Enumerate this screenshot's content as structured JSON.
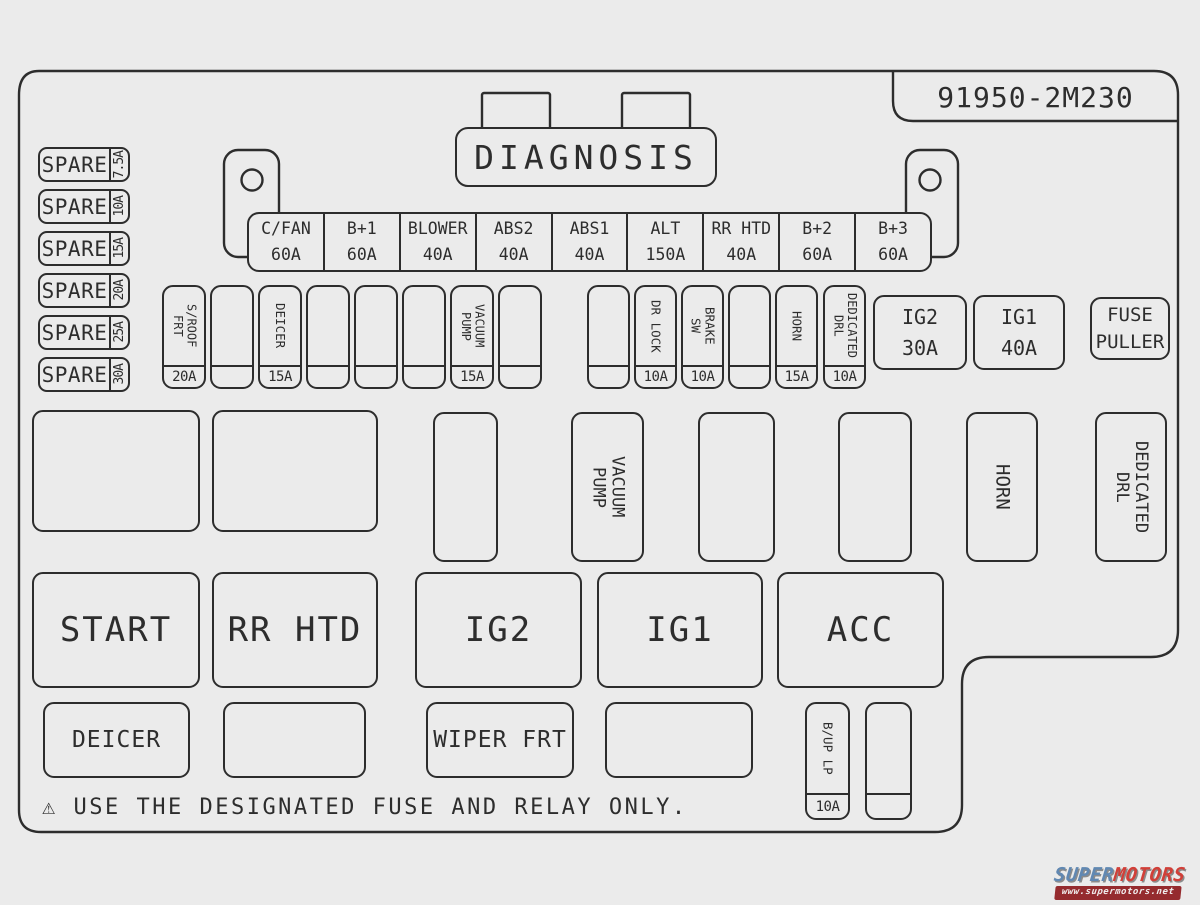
{
  "board": {
    "part_number": "91950-2M230",
    "diagnosis_label": "DIAGNOSIS",
    "warning_symbol": "⚠",
    "warning_text": "USE THE DESIGNATED FUSE AND RELAY ONLY.",
    "fuse_puller_label": "FUSE\nPULLER"
  },
  "spares": [
    {
      "label": "SPARE",
      "amp": "7.5A"
    },
    {
      "label": "SPARE",
      "amp": "10A"
    },
    {
      "label": "SPARE",
      "amp": "15A"
    },
    {
      "label": "SPARE",
      "amp": "20A"
    },
    {
      "label": "SPARE",
      "amp": "25A"
    },
    {
      "label": "SPARE",
      "amp": "30A"
    }
  ],
  "relay_strip": [
    {
      "name": "C/FAN",
      "amp": "60A"
    },
    {
      "name": "B+1",
      "amp": "60A"
    },
    {
      "name": "BLOWER",
      "amp": "40A"
    },
    {
      "name": "ABS2",
      "amp": "40A"
    },
    {
      "name": "ABS1",
      "amp": "40A"
    },
    {
      "name": "ALT",
      "amp": "150A"
    },
    {
      "name": "RR HTD",
      "amp": "40A"
    },
    {
      "name": "B+2",
      "amp": "60A"
    },
    {
      "name": "B+3",
      "amp": "60A"
    }
  ],
  "fuse_strip_a": [
    {
      "label": "S/ROOF\nFRT",
      "amp": "20A"
    },
    {
      "label": "",
      "amp": ""
    },
    {
      "label": "DEICER",
      "amp": "15A"
    },
    {
      "label": "",
      "amp": ""
    },
    {
      "label": "",
      "amp": ""
    },
    {
      "label": "",
      "amp": ""
    },
    {
      "label": "VACUUM\nPUMP",
      "amp": "15A"
    },
    {
      "label": "",
      "amp": ""
    }
  ],
  "fuse_strip_b": [
    {
      "label": "",
      "amp": ""
    },
    {
      "label": "DR LOCK",
      "amp": "10A"
    },
    {
      "label": "BRAKE\nSW",
      "amp": "10A"
    },
    {
      "label": "",
      "amp": ""
    },
    {
      "label": "HORN",
      "amp": "15A"
    },
    {
      "label": "DEDICATED\nDRL",
      "amp": "10A"
    }
  ],
  "ig_fuses": [
    {
      "name": "IG2",
      "amp": "30A"
    },
    {
      "name": "IG1",
      "amp": "40A"
    }
  ],
  "relay_boxes": [
    {
      "label": ""
    },
    {
      "label": ""
    },
    {
      "label": ""
    },
    {
      "label": "VACUUM\nPUMP"
    },
    {
      "label": ""
    },
    {
      "label": ""
    },
    {
      "label": "HORN"
    },
    {
      "label": "DEDICATED\nDRL"
    }
  ],
  "switch_row": [
    {
      "label": "START"
    },
    {
      "label": "RR HTD"
    },
    {
      "label": "IG2"
    },
    {
      "label": "IG1"
    },
    {
      "label": "ACC"
    }
  ],
  "bottom_row": [
    {
      "label": "DEICER"
    },
    {
      "label": ""
    },
    {
      "label": "WIPER FRT"
    },
    {
      "label": ""
    }
  ],
  "bottom_fuses": [
    {
      "label": "B/UP LP",
      "amp": "10A"
    },
    {
      "label": "",
      "amp": ""
    }
  ],
  "watermark": {
    "super": "SUPER",
    "motors": "MOTORS",
    "url": "www.supermotors.net"
  }
}
